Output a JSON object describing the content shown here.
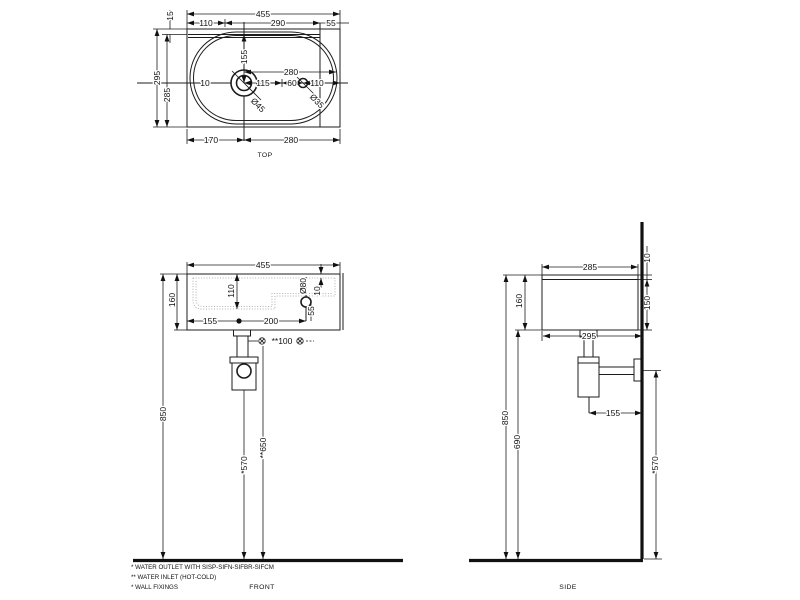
{
  "drawing": {
    "views": {
      "top": {
        "label": "TOP",
        "overall_width": "455",
        "back_offset": "110",
        "center_span": "290",
        "right_offset": "55",
        "rim_depth": "15",
        "overall_depth": "295",
        "inner_depth": "285",
        "side_gap": "10",
        "drain_from_back": "155",
        "drain_to_tap": "115",
        "tap_gap": "60",
        "tap_to_edge": "110",
        "drain_to_edge": "280",
        "drain_dia": "Ø45",
        "tap_dia": "Ø35",
        "drain_from_left": "170",
        "drain_to_right": "280"
      },
      "front": {
        "label": "FRONT",
        "overall_width": "455",
        "height": "160",
        "bowl_depth": "110",
        "drain_from_left": "155",
        "drain_to_tap": "200",
        "hole_dia": "Ø80",
        "hole_to_deck": "55",
        "rim_thickness": "10",
        "inlet_spacing": "**100",
        "rim_height": "850",
        "outlet_height": "*570",
        "inlet_height": "**650"
      },
      "side": {
        "label": "SIDE",
        "depth": "285",
        "rim_thickness": "10",
        "front_height": "150",
        "height": "160",
        "total_depth": "295",
        "trap_to_wall": "155",
        "rim_height": "850",
        "underside_height": "690",
        "outlet_height": "*570"
      }
    },
    "notes": {
      "outlet": "* WATER OUTLET WITH SISP-SIFN-SIFBR-SIFCM",
      "inlet": "** WATER INLET  (HOT-COLD)",
      "fixings": "* WALL FIXINGS"
    }
  }
}
